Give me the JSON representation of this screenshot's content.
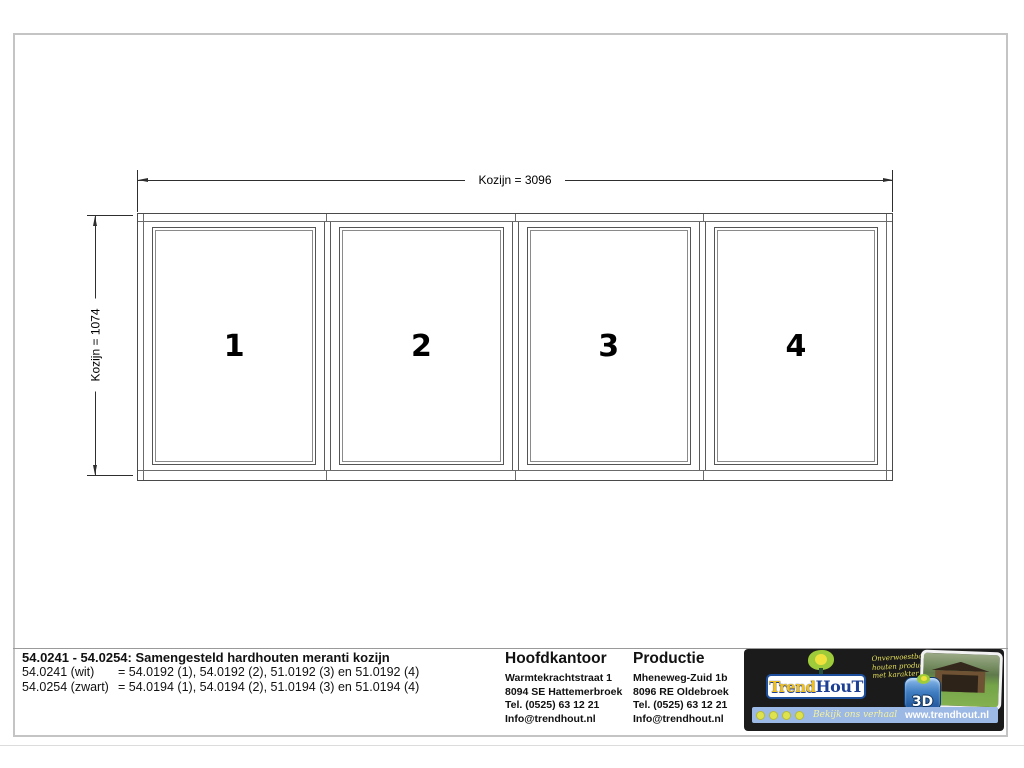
{
  "sheet": {
    "bg": "#ffffff",
    "border_color": "#c4c4c4"
  },
  "drawing": {
    "width_dimension_label": "Kozijn = 3096",
    "height_dimension_label": "Kozijn = 1074",
    "sections": [
      {
        "number": "1"
      },
      {
        "number": "2"
      },
      {
        "number": "3"
      },
      {
        "number": "4"
      }
    ]
  },
  "title_block": {
    "title": "54.0241 - 54.0254: Samengesteld hardhouten meranti kozijn",
    "variant_rows": [
      {
        "label": "54.0241 (wit)",
        "value": "= 54.0192 (1), 54.0192 (2), 51.0192 (3) en 51.0192 (4)"
      },
      {
        "label": "54.0254 (zwart)",
        "value": "= 54.0194 (1), 54.0194 (2), 51.0194 (3) en 51.0194 (4)"
      }
    ],
    "hoofdkantoor": {
      "heading": "Hoofdkantoor",
      "lines": [
        "Warmtekrachtstraat 1",
        "8094 SE Hattemerbroek",
        "Tel. (0525) 63 12 21",
        "Info@trendhout.nl"
      ]
    },
    "productie": {
      "heading": "Productie",
      "lines": [
        "Mheneweg-Zuid 1b",
        "8096 RE Oldebroek",
        "Tel. (0525) 63 12 21",
        "Info@trendhout.nl"
      ]
    },
    "logo": {
      "brand_trend": "Trend",
      "brand_hout": "HouT",
      "slogan_lines": [
        "Onverwoestbare",
        "houten producten",
        "met karakter"
      ],
      "badge_text": "3D",
      "social_icon_count": 4,
      "footer_tagline": "Bekijk ons verhaal",
      "website": "www.trendhout.nl",
      "colors": {
        "block_bg": "#1b1b1b",
        "brand_gold": "#f2c01d",
        "brand_navy": "#1c3f94",
        "strip_blue": "#9cb8e4",
        "tree_green": "#9ecb3a",
        "tree_yellow": "#f0e23c"
      }
    }
  }
}
